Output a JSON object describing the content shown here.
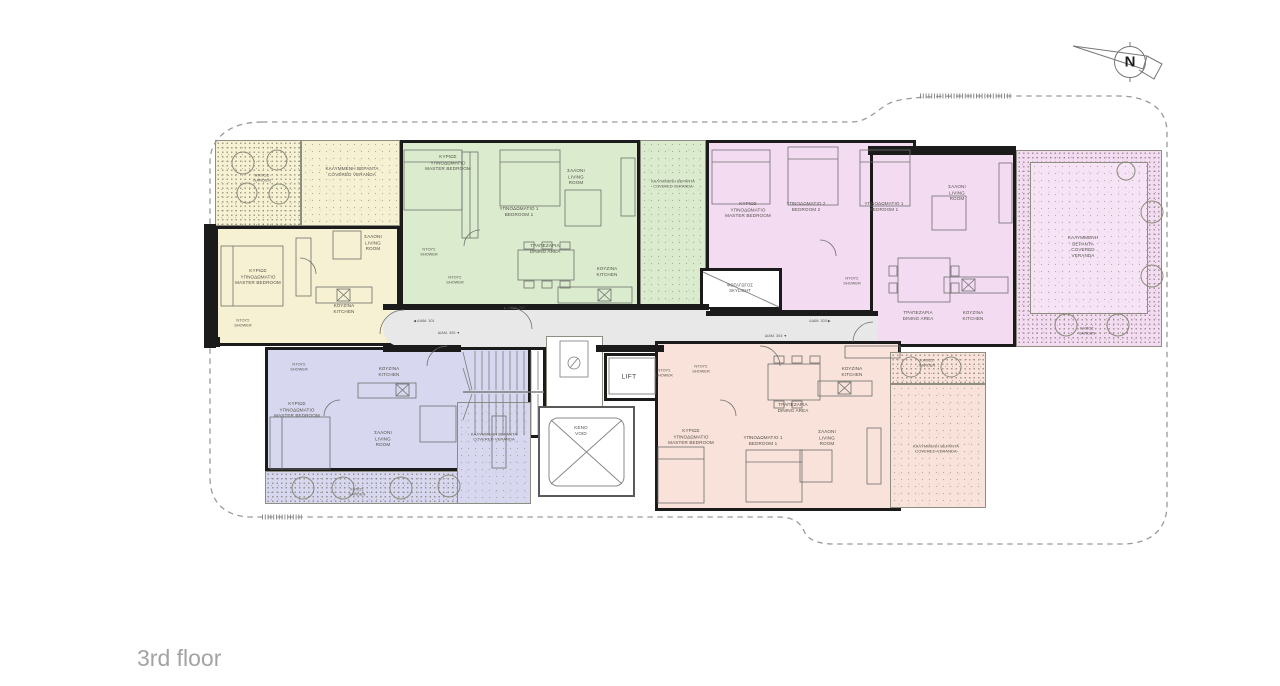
{
  "title": "3rd floor",
  "compass": {
    "north_label": "N"
  },
  "colors": {
    "apartment_yellow": "#f6f1d3",
    "apartment_green": "#daeccd",
    "apartment_pink": "#f3dcf2",
    "apartment_purple": "#d7d8ef",
    "apartment_salmon": "#f8e2da",
    "corridor_gray": "#e8e8e8",
    "wall_black": "#1b1b1b",
    "boundary_dash_gray": "#9a9a9a",
    "title_gray": "#a3a3a3"
  },
  "floor_plan": {
    "labels": [
      {
        "id": "yellow-garden",
        "x": 262,
        "y": 178,
        "fs": 4,
        "lines": [
          "ΚΗΠΟΣ",
          "GARDEN"
        ]
      },
      {
        "id": "yellow-covered-veranda",
        "x": 352,
        "y": 172,
        "fs": 4.6,
        "lines": [
          "ΚΑΛΥΜΜΕΝΗ ΒΕΡΑΝΤΑ",
          "COVERED VERANDA"
        ]
      },
      {
        "id": "yellow-master-bedroom",
        "x": 258,
        "y": 277,
        "fs": 4.6,
        "lines": [
          "ΚΥΡΙΩΣ",
          "ΥΠΝΟΔΩΜΑΤΙΟ",
          "MASTER BEDROOM"
        ]
      },
      {
        "id": "yellow-living-room",
        "x": 373,
        "y": 243,
        "fs": 4.6,
        "lines": [
          "ΣΑΛΟΝΙ",
          "LIVING",
          "ROOM"
        ]
      },
      {
        "id": "yellow-kitchen",
        "x": 344,
        "y": 309,
        "fs": 4.6,
        "lines": [
          "ΚΟΥΖΙΝΑ",
          "KITCHEN"
        ]
      },
      {
        "id": "yellow-shower",
        "x": 243,
        "y": 323,
        "fs": 3.8,
        "lines": [
          "ΝΤΟΥΣ",
          "SHOWER"
        ]
      },
      {
        "id": "green-master-bedroom",
        "x": 448,
        "y": 163,
        "fs": 4.6,
        "lines": [
          "ΚΥΡΙΩΣ",
          "ΥΠΝΟΔΩΜΑΤΙΟ",
          "MASTER BEDROOM"
        ]
      },
      {
        "id": "green-bedroom-1",
        "x": 519,
        "y": 212,
        "fs": 4.6,
        "lines": [
          "ΥΠΝΟΔΩΜΑΤΙΟ 1",
          "BEDROOM 1"
        ]
      },
      {
        "id": "green-living-room",
        "x": 576,
        "y": 177,
        "fs": 4.6,
        "lines": [
          "ΣΑΛΟΝΙ",
          "LIVING",
          "ROOM"
        ]
      },
      {
        "id": "green-dining-area",
        "x": 545,
        "y": 249,
        "fs": 4.6,
        "lines": [
          "ΤΡΑΠΕΖΑΡΙΑ",
          "DINING AREA"
        ]
      },
      {
        "id": "green-kitchen",
        "x": 607,
        "y": 272,
        "fs": 4.6,
        "lines": [
          "ΚΟΥΖΙΝΑ",
          "KITCHEN"
        ]
      },
      {
        "id": "green-shower-1",
        "x": 429,
        "y": 252,
        "fs": 3.8,
        "lines": [
          "ΝΤΟΥΣ",
          "SHOWER"
        ]
      },
      {
        "id": "green-shower-2",
        "x": 455,
        "y": 280,
        "fs": 3.8,
        "lines": [
          "ΝΤΟΥΣ",
          "SHOWER"
        ]
      },
      {
        "id": "green-covered-veranda",
        "x": 673,
        "y": 184,
        "fs": 3.8,
        "lines": [
          "ΚΑΛΥΜΜΕΝΗ ΒΕΡΑΝΤΑ",
          "COVERED VERANDA"
        ]
      },
      {
        "id": "pink-master-bedroom",
        "x": 748,
        "y": 210,
        "fs": 4.6,
        "lines": [
          "ΚΥΡΙΩΣ",
          "ΥΠΝΟΔΩΜΑΤΙΟ",
          "MASTER BEDROOM"
        ]
      },
      {
        "id": "pink-bedroom-2",
        "x": 806,
        "y": 207,
        "fs": 4.6,
        "lines": [
          "ΥΠΝΟΔΩΜΑΤΙΟ 2",
          "BEDROOM 2"
        ]
      },
      {
        "id": "pink-bedroom-1",
        "x": 884,
        "y": 207,
        "fs": 4.6,
        "lines": [
          "ΥΠΝΟΔΩΜΑΤΙΟ 1",
          "BEDROOM 1"
        ]
      },
      {
        "id": "pink-living-room",
        "x": 957,
        "y": 193,
        "fs": 4.6,
        "lines": [
          "ΣΑΛΟΝΙ",
          "LIVING",
          "ROOM"
        ]
      },
      {
        "id": "pink-dining-area",
        "x": 918,
        "y": 316,
        "fs": 4.6,
        "lines": [
          "ΤΡΑΠΕΖΑΡΙΑ",
          "DINING AREA"
        ]
      },
      {
        "id": "pink-kitchen",
        "x": 973,
        "y": 316,
        "fs": 4.6,
        "lines": [
          "ΚΟΥΖΙΝΑ",
          "KITCHEN"
        ]
      },
      {
        "id": "pink-shower",
        "x": 852,
        "y": 281,
        "fs": 3.8,
        "lines": [
          "ΝΤΟΥΣ",
          "SHOWER"
        ]
      },
      {
        "id": "skylight",
        "x": 740,
        "y": 288,
        "fs": 4.2,
        "lines": [
          "ΦΩΤΑΓΩΓΟΣ",
          "SKYLIGHT"
        ]
      },
      {
        "id": "pink-covered-veranda",
        "x": 1083,
        "y": 247,
        "fs": 4.6,
        "lines": [
          "ΚΑΛΥΜΜΕΝΗ",
          "ΒΕΡΑΝΤΑ",
          "COVERED",
          "VERANDA"
        ]
      },
      {
        "id": "pink-garden",
        "x": 1087,
        "y": 331,
        "fs": 3.8,
        "lines": [
          "ΚΗΠΟΣ",
          "GARDEN"
        ]
      },
      {
        "id": "purple-shower",
        "x": 299,
        "y": 367,
        "fs": 3.8,
        "lines": [
          "ΝΤΟΥΣ",
          "SHOWER"
        ]
      },
      {
        "id": "purple-master-bedroom",
        "x": 297,
        "y": 410,
        "fs": 4.6,
        "lines": [
          "ΚΥΡΙΩΣ",
          "ΥΠΝΟΔΩΜΑΤΙΟ",
          "MASTER BEDROOM"
        ]
      },
      {
        "id": "purple-kitchen",
        "x": 389,
        "y": 372,
        "fs": 4.6,
        "lines": [
          "ΚΟΥΖΙΝΑ",
          "KITCHEN"
        ]
      },
      {
        "id": "purple-living-room",
        "x": 383,
        "y": 439,
        "fs": 4.6,
        "lines": [
          "ΣΑΛΟΝΙ",
          "LIVING",
          "ROOM"
        ]
      },
      {
        "id": "purple-covered-veranda",
        "x": 494,
        "y": 437,
        "fs": 4,
        "lines": [
          "ΚΑΛΥΜΜΕΝΗ ΒΕΡΑΝΤΑ",
          "COVERED VERANDA"
        ]
      },
      {
        "id": "purple-garden",
        "x": 357,
        "y": 492,
        "fs": 3.8,
        "lines": [
          "ΚΗΠΟΣ",
          "GARDEN"
        ]
      },
      {
        "id": "salmon-shower-1",
        "x": 664,
        "y": 373,
        "fs": 3.8,
        "lines": [
          "ΝΤΟΥΣ",
          "SHOWER"
        ]
      },
      {
        "id": "salmon-shower-2",
        "x": 701,
        "y": 369,
        "fs": 3.8,
        "lines": [
          "ΝΤΟΥΣ",
          "SHOWER"
        ]
      },
      {
        "id": "salmon-master-bedroom",
        "x": 691,
        "y": 437,
        "fs": 4.6,
        "lines": [
          "ΚΥΡΙΩΣ",
          "ΥΠΝΟΔΩΜΑΤΙΟ",
          "MASTER BEDROOM"
        ]
      },
      {
        "id": "salmon-bedroom-1",
        "x": 763,
        "y": 441,
        "fs": 4.6,
        "lines": [
          "ΥΠΝΟΔΩΜΑΤΙΟ 1",
          "BEDROOM 1"
        ]
      },
      {
        "id": "salmon-dining-area",
        "x": 793,
        "y": 408,
        "fs": 4.6,
        "lines": [
          "ΤΡΑΠΕΖΑΡΙΑ",
          "DINING AREA"
        ]
      },
      {
        "id": "salmon-kitchen",
        "x": 852,
        "y": 372,
        "fs": 4.6,
        "lines": [
          "ΚΟΥΖΙΝΑ",
          "KITCHEN"
        ]
      },
      {
        "id": "salmon-living-room",
        "x": 827,
        "y": 438,
        "fs": 4.6,
        "lines": [
          "ΣΑΛΟΝΙ",
          "LIVING",
          "ROOM"
        ]
      },
      {
        "id": "salmon-garden",
        "x": 927,
        "y": 363,
        "fs": 3.8,
        "lines": [
          "ΚΗΠΟΣ",
          "GARDEN"
        ]
      },
      {
        "id": "salmon-covered-veranda",
        "x": 936,
        "y": 449,
        "fs": 4,
        "lines": [
          "ΚΑΛΥΜΜΕΝΗ ΒΕΡΑΝΤΑ",
          "COVERED VERANDA"
        ]
      },
      {
        "id": "lift",
        "x": 629,
        "y": 377,
        "fs": 6.5,
        "cls": "lift",
        "lines": [
          "LIFT"
        ]
      },
      {
        "id": "void",
        "x": 581,
        "y": 431,
        "fs": 4.6,
        "lines": [
          "ΚΕΝΟ",
          "VOID"
        ]
      },
      {
        "id": "compass-north",
        "x": 1130,
        "y": 63,
        "fs": 15,
        "cls": "compass",
        "lines": [
          "N"
        ]
      },
      {
        "id": "entry-apt-301",
        "x": 424,
        "y": 321,
        "fs": 3.6,
        "lines": [
          "◀ ΔΙΑΜ. 301"
        ]
      },
      {
        "id": "entry-apt-305",
        "x": 449,
        "y": 333,
        "fs": 3.6,
        "lines": [
          "ΔΙΑΜ. 305 ▼"
        ]
      },
      {
        "id": "entry-apt-302",
        "x": 514,
        "y": 308,
        "fs": 3.6,
        "lines": [
          "▲ ΔΙΑΜ. 302"
        ]
      },
      {
        "id": "entry-apt-303",
        "x": 820,
        "y": 321,
        "fs": 3.6,
        "lines": [
          "ΔΙΑΜ. 303 ▶"
        ]
      },
      {
        "id": "entry-apt-304",
        "x": 776,
        "y": 336,
        "fs": 3.6,
        "lines": [
          "ΔΙΑΜ. 304 ▼"
        ]
      }
    ]
  }
}
